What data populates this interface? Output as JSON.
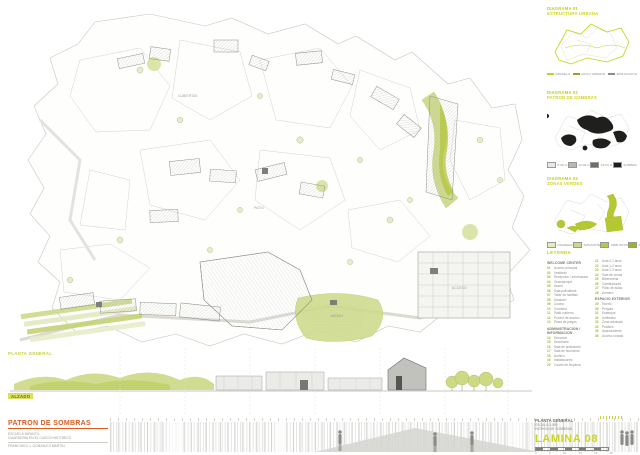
{
  "sheet": {
    "title_block": {
      "title": "PATRON DE SOMBRAS",
      "lines": [
        "ESCUELA INFANTIL",
        "GUARDERIA EN EL CASCO HISTORICO",
        "FRANCISCO J. GONZALEZ MARTIN"
      ]
    },
    "info_block": {
      "lines": [
        "PLANTA GENERAL",
        "ESCALA 1:500",
        "PATRON DE SOMBRAS"
      ],
      "sheet_number": "LAMINA 08",
      "ruler_numbers": [
        "0",
        "5",
        "10",
        "15",
        "20",
        "25"
      ]
    }
  },
  "plan": {
    "label_left": "PLANTA GENERAL",
    "label_elevation": "ALZADO",
    "annotations": [
      {
        "label": "CUBIERTAS"
      },
      {
        "label": "PATIO"
      },
      {
        "label": "JARDIN"
      },
      {
        "label": "ACCESO"
      }
    ]
  },
  "panels": [
    {
      "title1": "DIAGRAMA 01",
      "title2": "ESTRUCTURA URBANA",
      "legend": [
        {
          "style": "line",
          "color": "#c3d117",
          "label": "PARCELA"
        },
        {
          "style": "line",
          "color": "#9aa41a",
          "label": "VACIO URBANO"
        },
        {
          "style": "line",
          "color": "#8c8c87",
          "label": "EDIFICACION"
        }
      ]
    },
    {
      "title1": "DIAGRAMA 02",
      "title2": "PATRON DE SOMBRAS",
      "legend": [
        {
          "style": "box",
          "color": "#e8e8e4",
          "label": "8:00 H"
        },
        {
          "style": "box",
          "color": "#b9b9b4",
          "label": "12:00 H"
        },
        {
          "style": "box",
          "color": "#6f6f6a",
          "label": "16:00 H"
        },
        {
          "style": "box",
          "color": "#1d1d1b",
          "label": "SOMBRA"
        }
      ]
    },
    {
      "title1": "DIAGRAMA 03",
      "title2": "ZONAS VERDES",
      "legend": [
        {
          "style": "box",
          "color": "#e6ecba",
          "label": "PRADERA"
        },
        {
          "style": "box",
          "color": "#cdd98a",
          "label": "TAPIZANTE"
        },
        {
          "style": "box",
          "color": "#b4c84e",
          "label": "ARBUSTOS"
        },
        {
          "style": "box",
          "color": "#9cb421",
          "label": "ARBOLADO"
        }
      ]
    }
  ],
  "legend": {
    "header": "LEYENDA",
    "columns": [
      {
        "sections": [
          {
            "header": "WELCOME CENTER",
            "items": [
              {
                "n": "01",
                "label": "Acceso principal"
              },
              {
                "n": "02",
                "label": "Vestibulo"
              },
              {
                "n": "03",
                "label": "Recepcion / informacion"
              },
              {
                "n": "04",
                "label": "Guardarropa"
              },
              {
                "n": "05",
                "label": "Aseos"
              },
              {
                "n": "06",
                "label": "Sala polivalente"
              },
              {
                "n": "07",
                "label": "Taller de familias"
              },
              {
                "n": "08",
                "label": "Almacen"
              },
              {
                "n": "09",
                "label": "Cocina"
              },
              {
                "n": "10",
                "label": "Comedor"
              },
              {
                "n": "11",
                "label": "Patio cubierto"
              },
              {
                "n": "12",
                "label": "Porche de acceso"
              },
              {
                "n": "13",
                "label": "Plaza de juegos"
              }
            ]
          },
          {
            "header": "ADMINISTRACION / INFORMACION",
            "items": [
              {
                "n": "14",
                "label": "Direccion"
              },
              {
                "n": "15",
                "label": "Secretaria"
              },
              {
                "n": "16",
                "label": "Sala de profesores"
              },
              {
                "n": "17",
                "label": "Sala de reuniones"
              },
              {
                "n": "18",
                "label": "Archivo"
              },
              {
                "n": "19",
                "label": "Instalaciones"
              },
              {
                "n": "20",
                "label": "Cuarto de limpieza"
              }
            ]
          }
        ]
      },
      {
        "sections": [
          {
            "header": "",
            "items": [
              {
                "n": "21",
                "label": "Aula 0-1 anos"
              },
              {
                "n": "22",
                "label": "Aula 1-2 anos"
              },
              {
                "n": "23",
                "label": "Aula 2-3 anos"
              },
              {
                "n": "24",
                "label": "Sala de cunas"
              },
              {
                "n": "25",
                "label": "Biberoneria"
              },
              {
                "n": "26",
                "label": "Cambiadores"
              },
              {
                "n": "27",
                "label": "Patio de aulas"
              },
              {
                "n": "28",
                "label": "Arenero"
              }
            ]
          },
          {
            "header": "ESPACIO EXTERIOR",
            "items": [
              {
                "n": "29",
                "label": "Huerto"
              },
              {
                "n": "30",
                "label": "Pergola"
              },
              {
                "n": "31",
                "label": "Estanque"
              },
              {
                "n": "32",
                "label": "Anfiteatro"
              },
              {
                "n": "33",
                "label": "Zona arbolada"
              },
              {
                "n": "34",
                "label": "Pradera"
              },
              {
                "n": "35",
                "label": "Aparcamiento"
              },
              {
                "n": "36",
                "label": "Acceso rodado"
              }
            ]
          }
        ]
      }
    ]
  },
  "colors": {
    "accent_yellow": "#c9d521",
    "accent_orange": "#df5a1e",
    "green_light": "#d0dc8f",
    "green_bright": "#b5c832",
    "shadow_black": "#1d1d1b"
  }
}
